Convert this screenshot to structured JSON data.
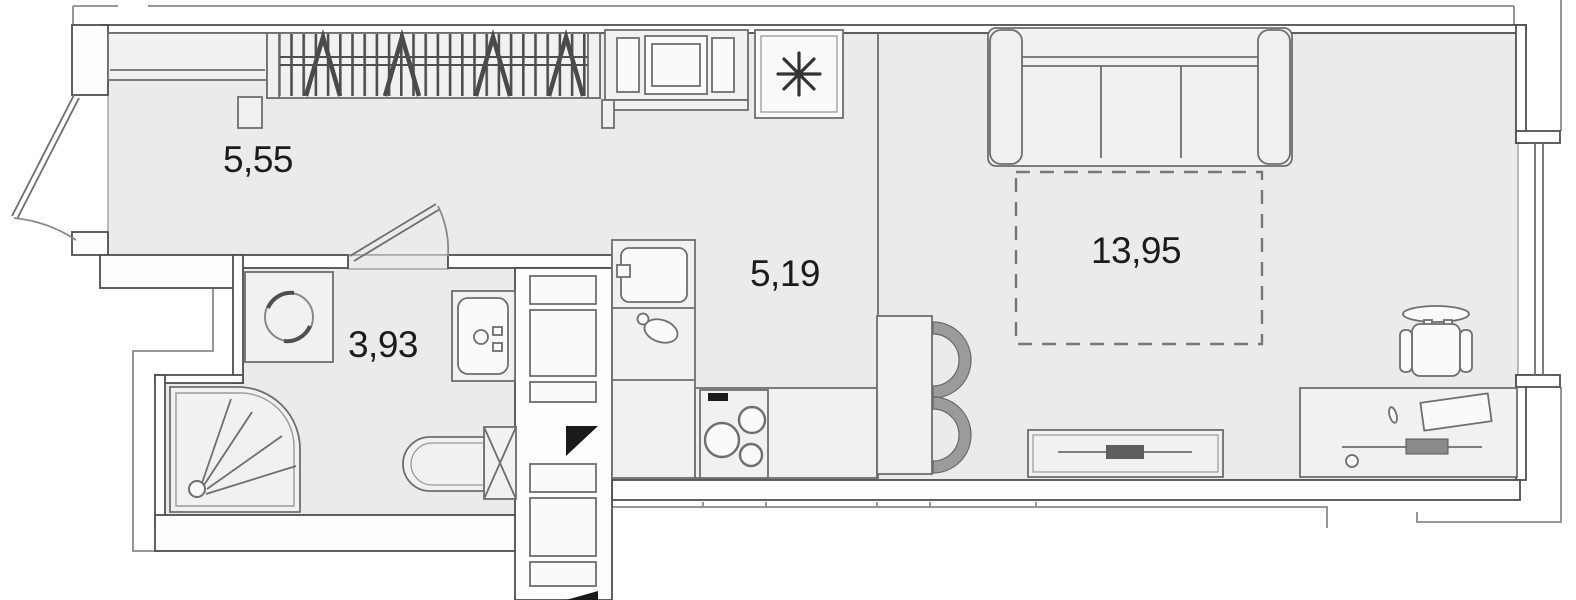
{
  "plan": {
    "type": "apartment-floor-plan",
    "units": "m2",
    "rooms": [
      {
        "id": "hallway",
        "area_label": "5,55"
      },
      {
        "id": "bathroom",
        "area_label": "3,93"
      },
      {
        "id": "kitchen",
        "area_label": "5,19"
      },
      {
        "id": "living-room",
        "area_label": "13,95"
      }
    ],
    "furniture": [
      "entrance-door",
      "hall-cabinet",
      "wardrobe-with-hangers",
      "oven-unit",
      "fridge",
      "kitchen-sink",
      "kettle",
      "stove",
      "kitchen-counter",
      "dining-table",
      "dining-chairs",
      "zone-divider",
      "sofa",
      "bed-dashed-outline",
      "tv-stand",
      "tv",
      "desk",
      "desk-chair",
      "bathroom-door",
      "washing-machine",
      "bathroom-sink",
      "toilet",
      "shower",
      "duct-shaft",
      "window"
    ],
    "colors": {
      "bg": "#ffffff",
      "floor": "#ebebeb",
      "wall_fill": "#fdfdfd",
      "line": "#4f4f4f",
      "furn": "#f1f1f1",
      "label": "#1b1b1b"
    }
  }
}
